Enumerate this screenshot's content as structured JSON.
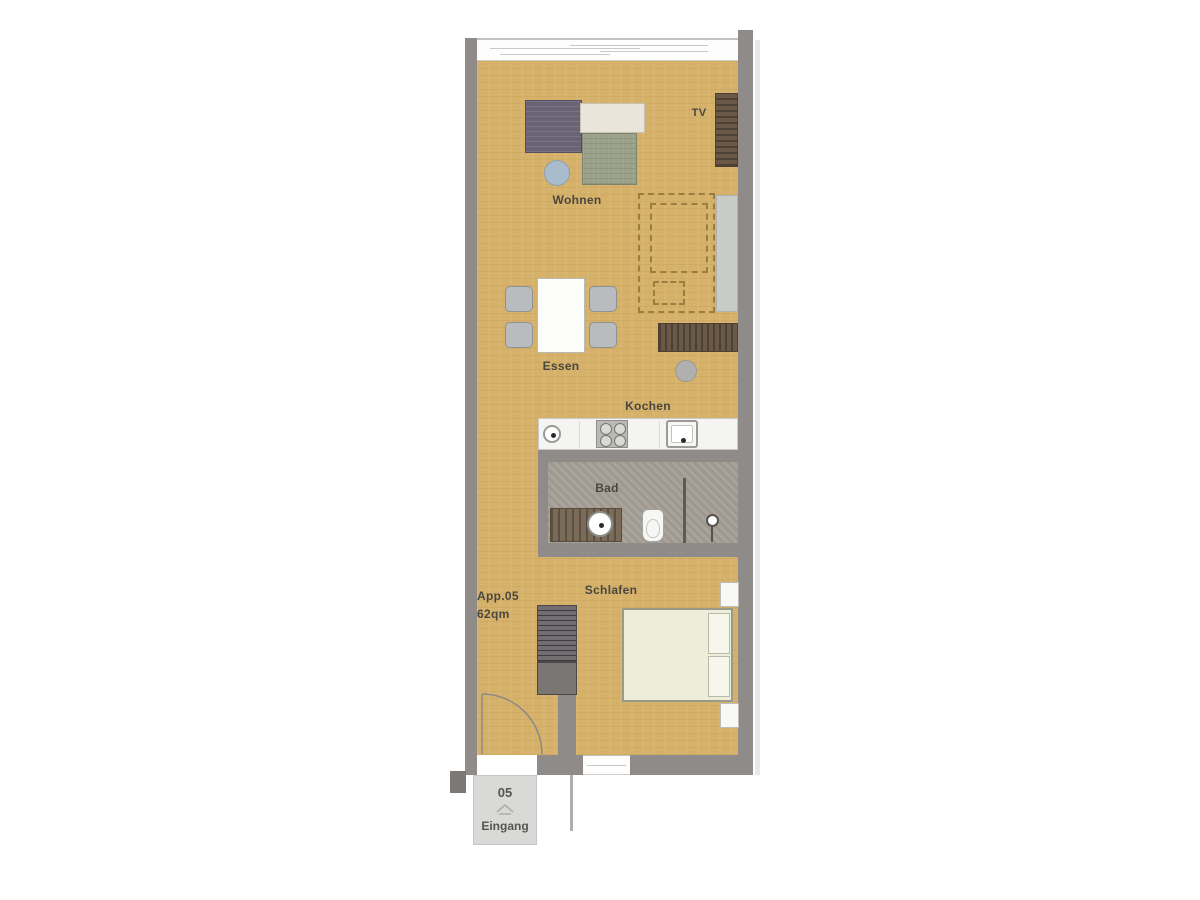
{
  "plan": {
    "unit": {
      "id_label": "App.05",
      "area_label": "62qm"
    },
    "entrance": {
      "unit_number": "05",
      "label": "Eingang"
    },
    "rooms": {
      "living": "Wohnen",
      "dining": "Essen",
      "kitchen": "Kochen",
      "bath": "Bad",
      "bedroom": "Schlafen"
    },
    "tv_label": "TV",
    "colors": {
      "wood_floor": "#d6b169",
      "wall": "#8e8b89",
      "bath_floor": "#a59e96",
      "counter": "#f4f4f2",
      "sofa_dark": "#6a6375",
      "sofa_cream": "#eae4da",
      "sofa_green": "#9aa089",
      "side_table": "#a9bccb",
      "cabinet_wood": "#6b5948",
      "bed": "#edeeda",
      "chair": "#b9bcbe",
      "entrance_block": "#d9d9d7",
      "dashed_outline": "#9b7d3f"
    }
  }
}
